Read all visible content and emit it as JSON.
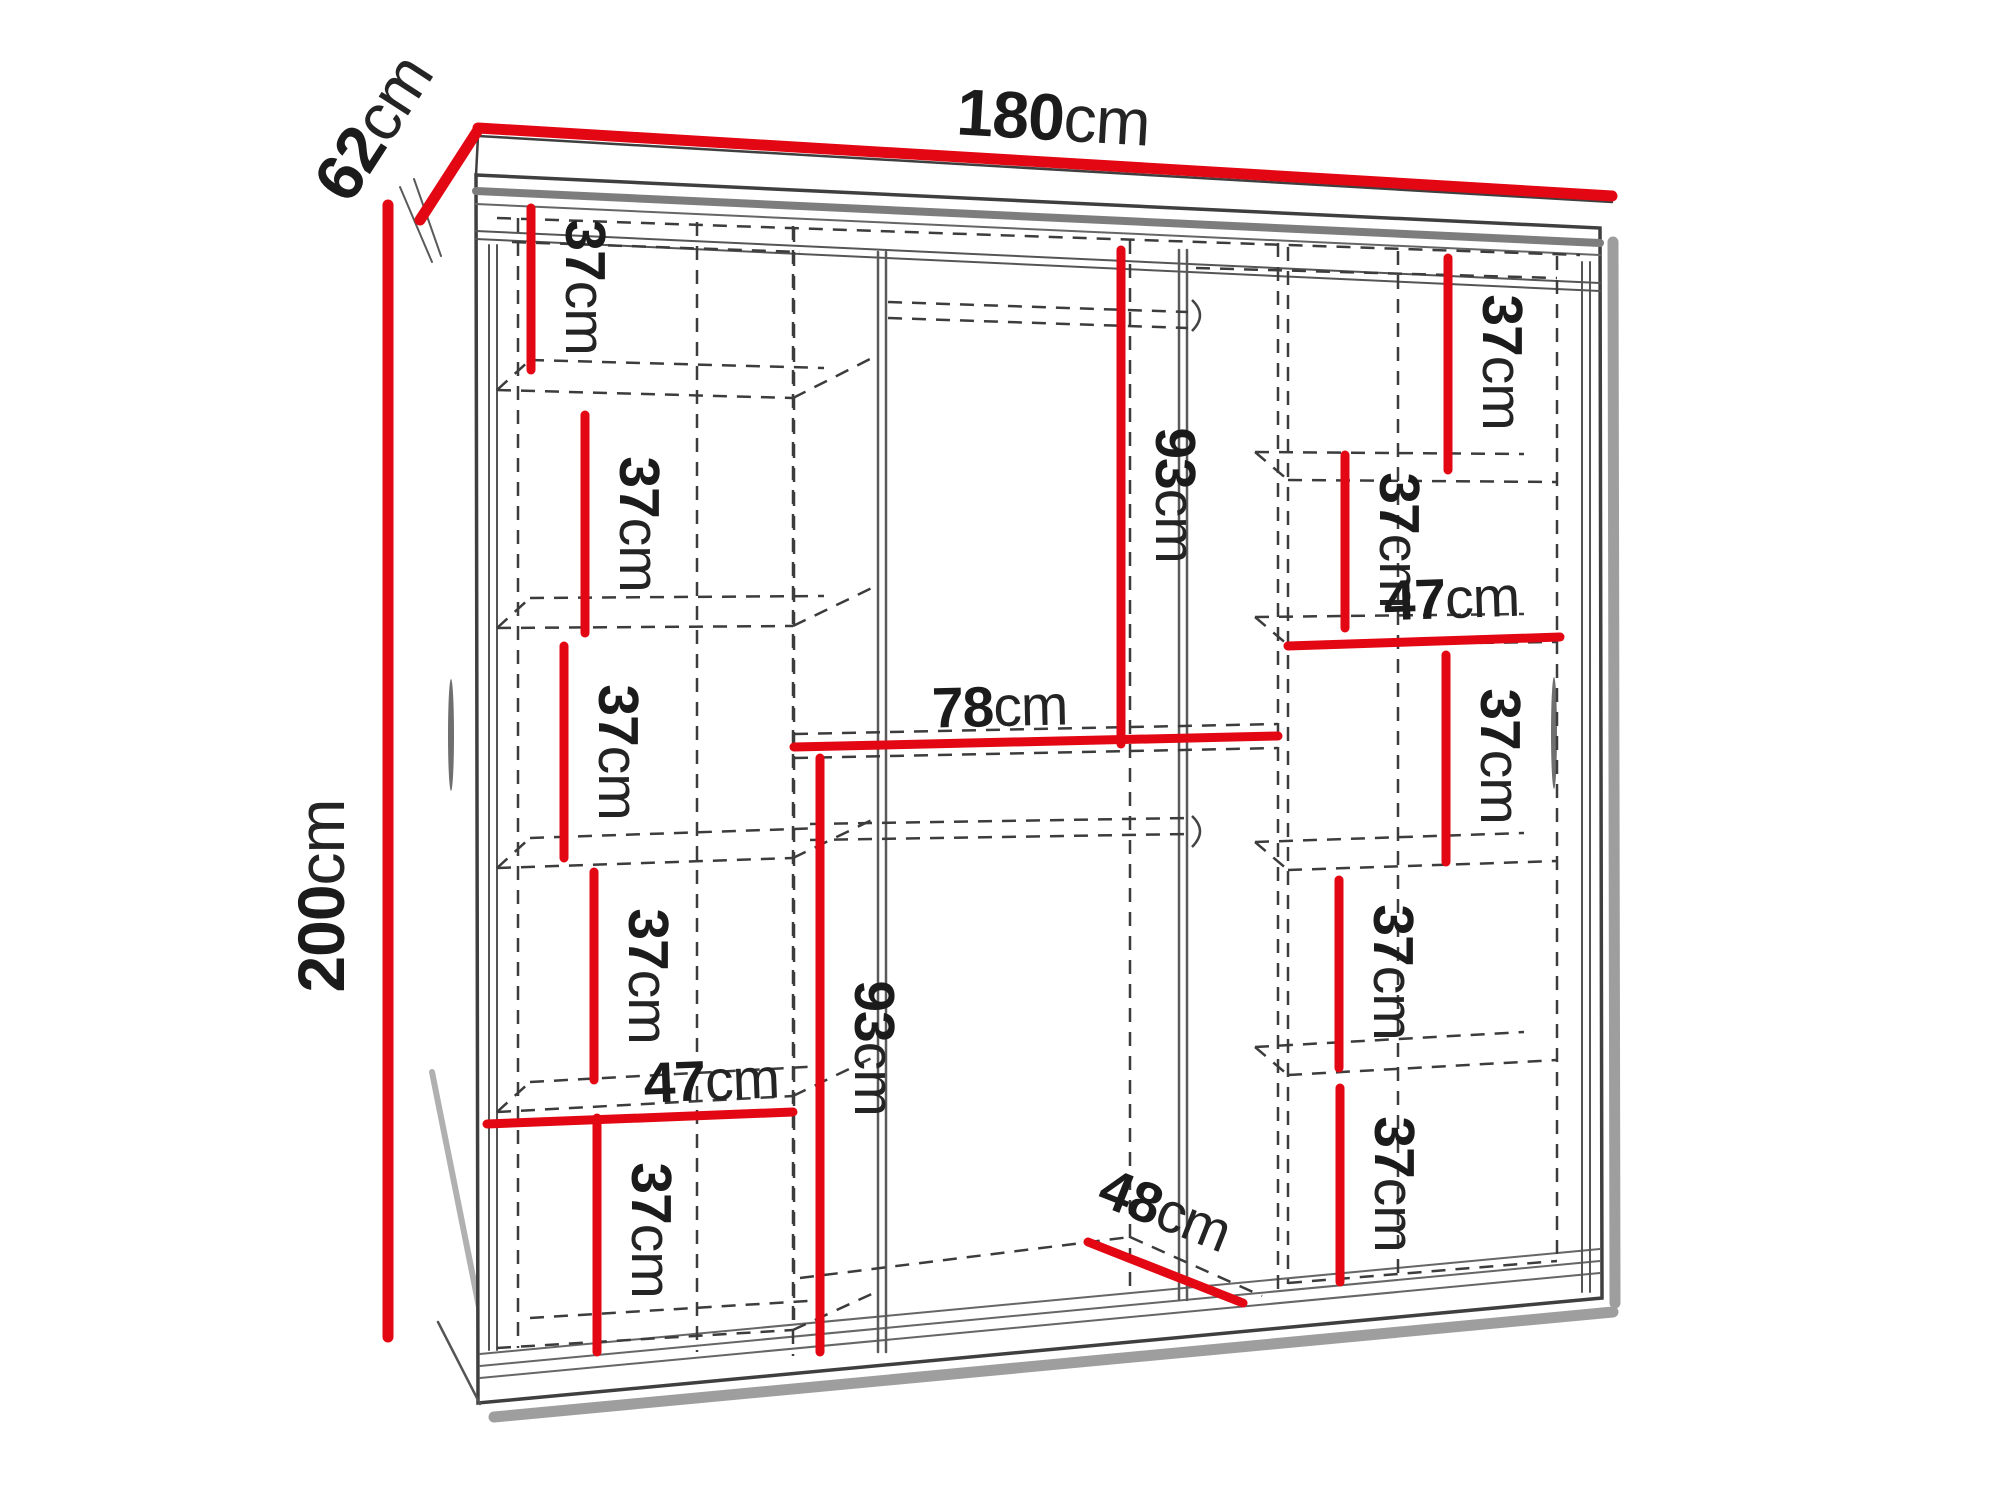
{
  "diagram": {
    "type": "furniture-dimension-diagram",
    "subject": "Sliding-door wardrobe shown in perspective with interior shelf and rail dimensions",
    "background": "#ffffff",
    "colors": {
      "dimension_line": "#e30613",
      "outline": "#3f3f3f",
      "dashed_line": "#3c3c3c",
      "label_text": "#1b1b1b",
      "shadow": "#9e9e9e"
    },
    "overall_dimensions": {
      "width": {
        "value": "180",
        "unit": "cm"
      },
      "depth": {
        "value": "62",
        "unit": "cm"
      },
      "height": {
        "value": "200",
        "unit": "cm"
      }
    },
    "interior_dimensions": [
      {
        "id": "left-gap-1",
        "value": "37",
        "unit": "cm"
      },
      {
        "id": "left-gap-2",
        "value": "37",
        "unit": "cm"
      },
      {
        "id": "left-gap-3",
        "value": "37",
        "unit": "cm"
      },
      {
        "id": "left-gap-4",
        "value": "37",
        "unit": "cm"
      },
      {
        "id": "left-column-width",
        "value": "47",
        "unit": "cm"
      },
      {
        "id": "left-gap-5",
        "value": "37",
        "unit": "cm"
      },
      {
        "id": "middle-upper-height",
        "value": "93",
        "unit": "cm"
      },
      {
        "id": "middle-width",
        "value": "78",
        "unit": "cm"
      },
      {
        "id": "middle-lower-height",
        "value": "93",
        "unit": "cm"
      },
      {
        "id": "middle-depth",
        "value": "48",
        "unit": "cm"
      },
      {
        "id": "right-gap-1",
        "value": "37",
        "unit": "cm"
      },
      {
        "id": "right-gap-2",
        "value": "37",
        "unit": "cm"
      },
      {
        "id": "right-column-width",
        "value": "47",
        "unit": "cm"
      },
      {
        "id": "right-gap-3",
        "value": "37",
        "unit": "cm"
      },
      {
        "id": "right-gap-4",
        "value": "37",
        "unit": "cm"
      },
      {
        "id": "right-gap-5",
        "value": "37",
        "unit": "cm"
      }
    ]
  }
}
